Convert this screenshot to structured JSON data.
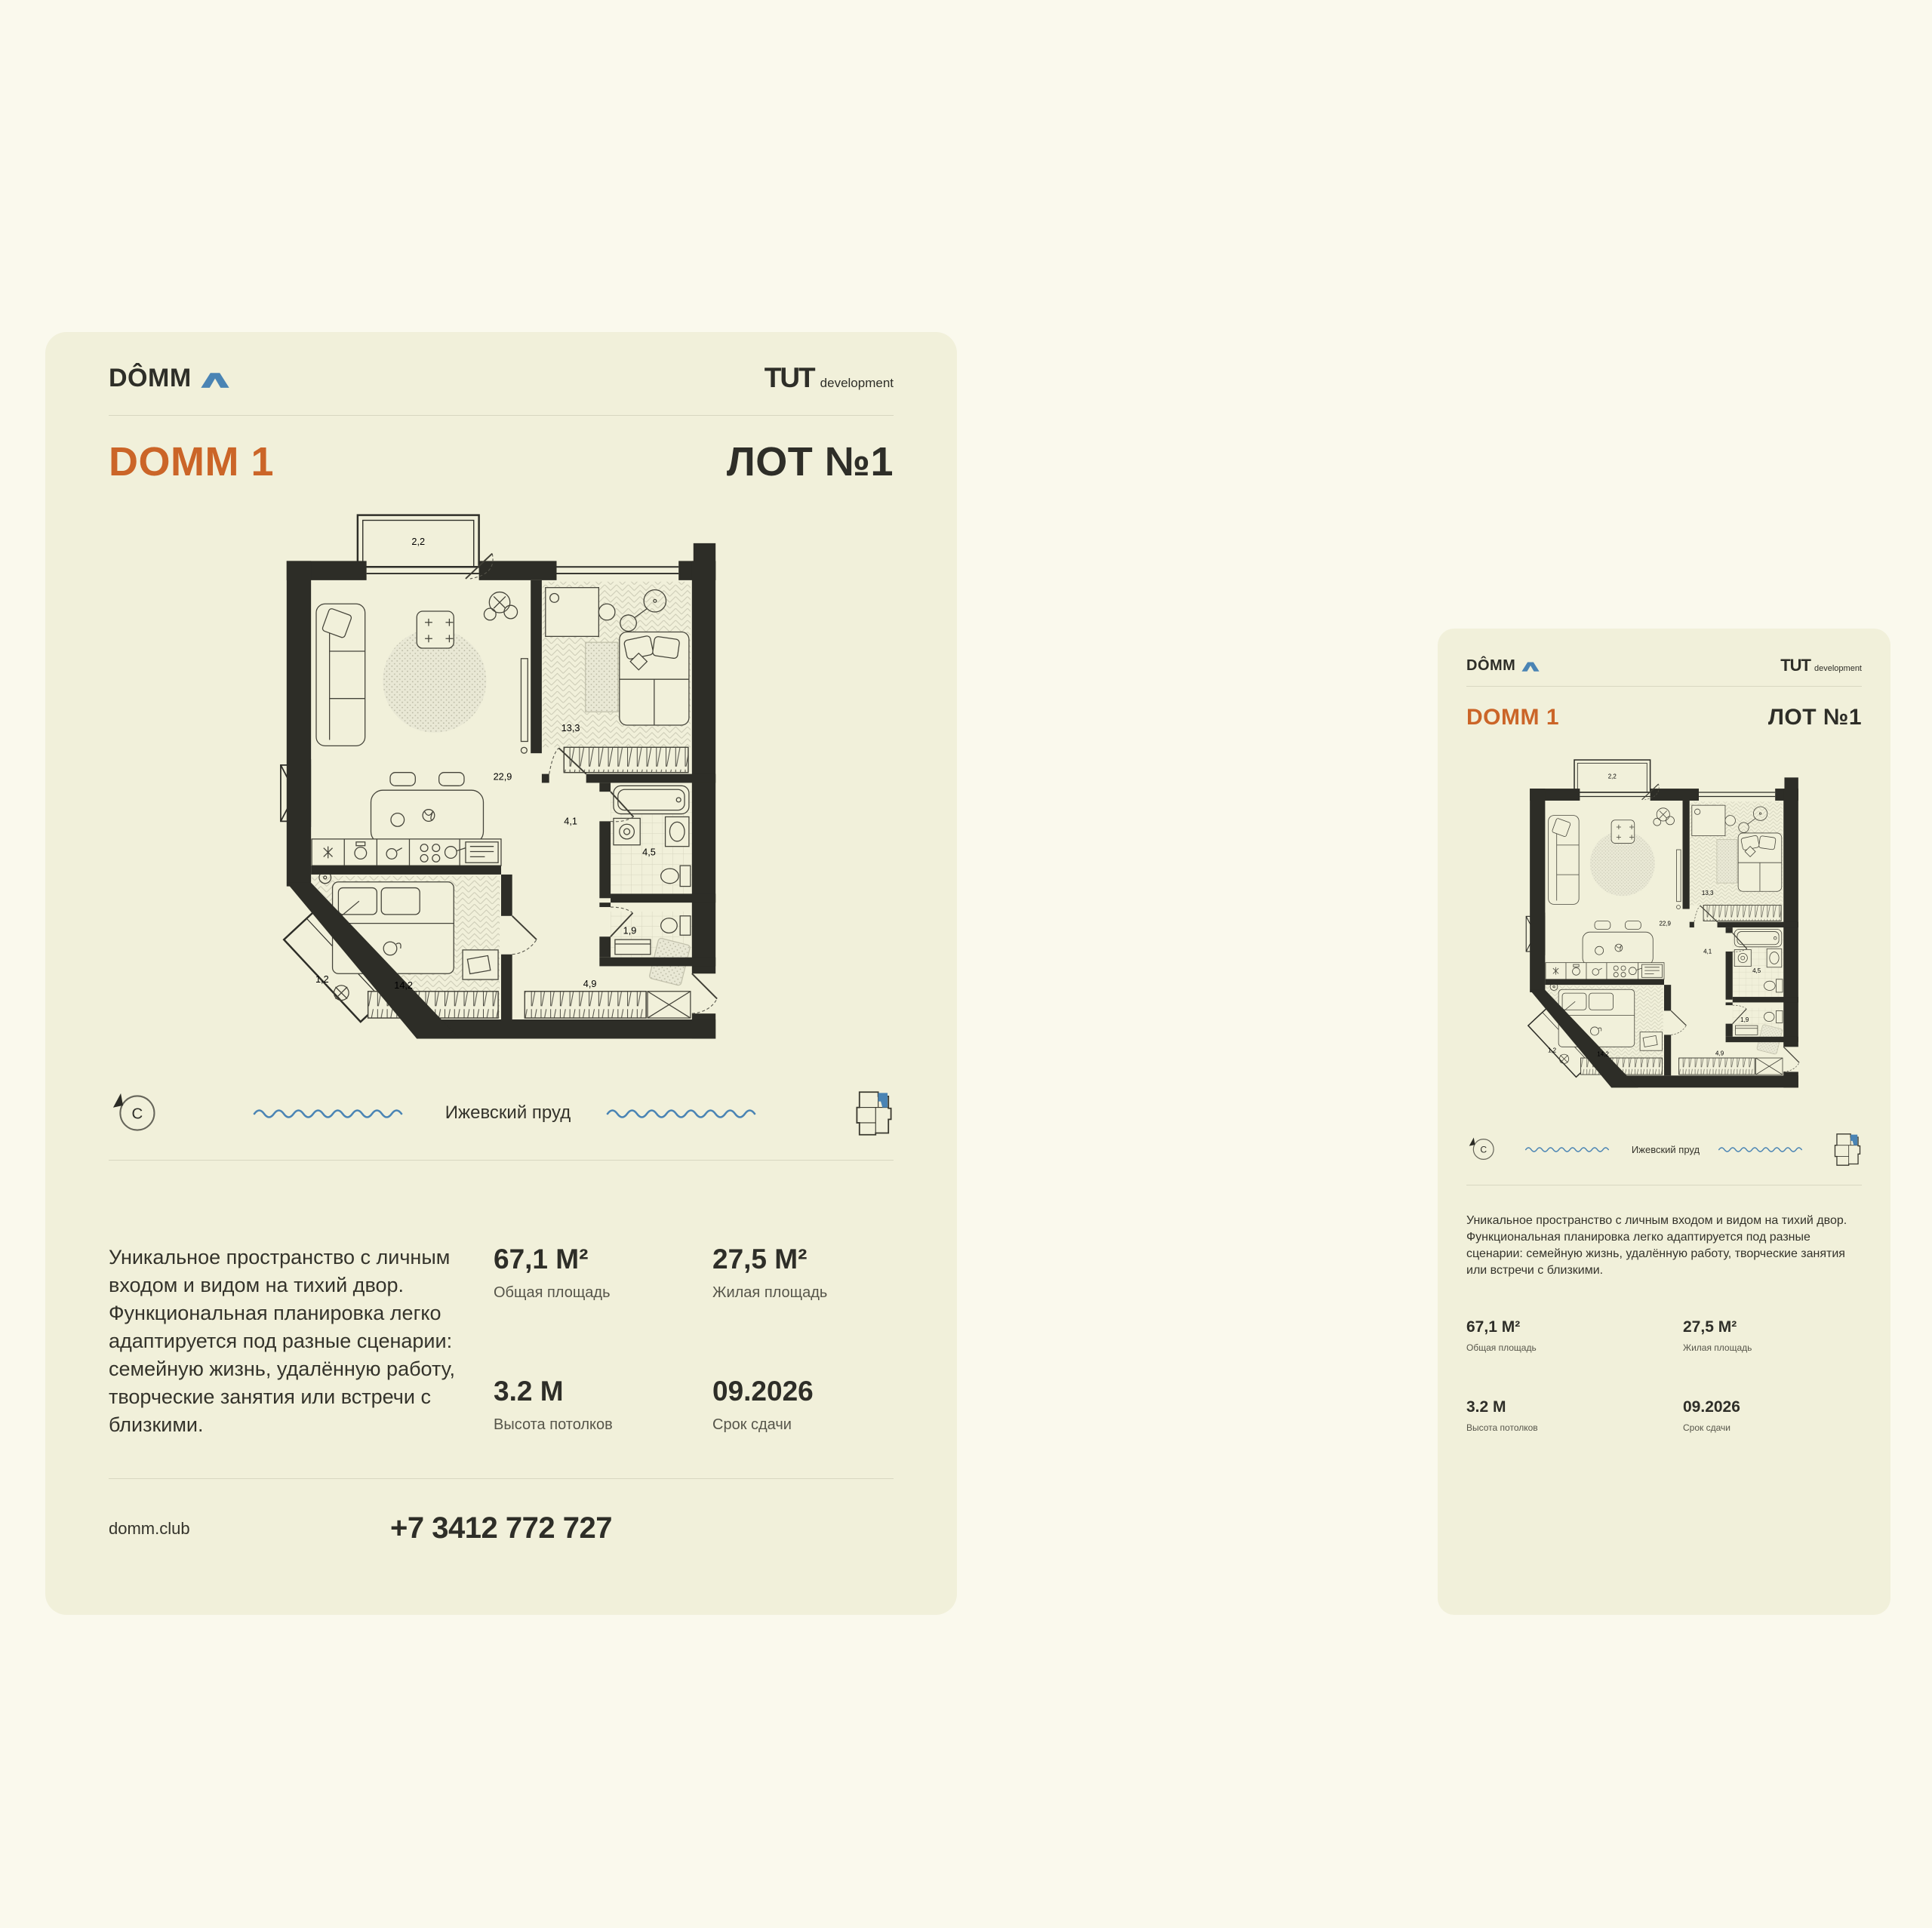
{
  "colors": {
    "page_bg": "#FAF9ED",
    "card_bg": "#F1F0DA",
    "ink": "#2E2E28",
    "accent_orange": "#CB6528",
    "brand_blue": "#4A84B4",
    "divider": "#D8D7C1"
  },
  "brand": {
    "logo_text": "DÔMM",
    "developer_name": "TUT",
    "developer_suffix": "development"
  },
  "listing": {
    "project_title": "DOMM 1",
    "lot_label": "ЛОТ №1",
    "description": "Уникальное пространство с личным входом и видом на тихий двор. Функциональная планировка легко адаптируется под разные сценарии: семейную жизнь, удалённую работу, творческие занятия или встречи с близкими.",
    "stats": [
      {
        "value": "67,1 М²",
        "label": "Общая площадь"
      },
      {
        "value": "27,5 М²",
        "label": "Жилая площадь"
      },
      {
        "value": "3.2 М",
        "label": "Высота потолков"
      },
      {
        "value": "09.2026",
        "label": "Срок сдачи"
      }
    ],
    "website": "domm.club",
    "phone": "+7 3412 772 727"
  },
  "location": {
    "compass_letter": "С",
    "water_label": "Ижевский пруд"
  },
  "floor_plan": {
    "areas": {
      "balcony_top": "2,2",
      "living_kitchen": "22,9",
      "bedroom": "13,3",
      "hall": "4,1",
      "bathroom": "4,5",
      "wc": "1,9",
      "bedroom_second": "14,2",
      "hallway": "4,9",
      "balcony_corner": "1,2"
    }
  }
}
